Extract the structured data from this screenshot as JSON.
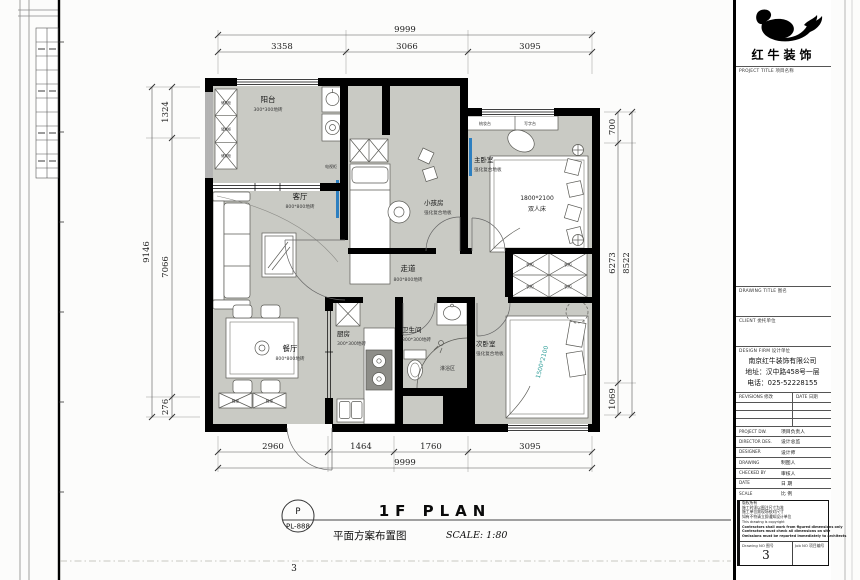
{
  "plan": {
    "rooms": [
      {
        "id": "balcony",
        "name": "阳台",
        "finish": "300*300地砖"
      },
      {
        "id": "living",
        "name": "客厅",
        "finish": "800*800地砖"
      },
      {
        "id": "kids",
        "name": "小孩房",
        "finish": "强化复合地板"
      },
      {
        "id": "master",
        "name": "主卧室",
        "finish": "强化复合地板"
      },
      {
        "id": "corridor",
        "name": "走道",
        "finish": "800*800地砖"
      },
      {
        "id": "dining",
        "name": "餐厅",
        "finish": "800*800地砖"
      },
      {
        "id": "kitchen",
        "name": "厨房",
        "finish": "300*300地砖"
      },
      {
        "id": "bath",
        "name": "卫生间",
        "finish": "300*300地砖"
      },
      {
        "id": "shower",
        "name": "淋浴区"
      },
      {
        "id": "second",
        "name": "次卧室",
        "finish": "强化复合地板"
      }
    ],
    "furniture": {
      "tv_cabinet": "电视柜",
      "dressing_table": "梳妆台",
      "writing_desk": "写字台",
      "master_bed_size": "1800*2100",
      "master_bed_name": "双人床",
      "second_bed_size": "1500*2100",
      "wardrobe": "衣柜",
      "shoe_cabinet": "鞋柜",
      "balcony_cabinet": "储物柜"
    },
    "dimensions": {
      "top": {
        "overall": "9999",
        "segments": [
          "3358",
          "3066",
          "3095"
        ]
      },
      "bottom": {
        "overall": "9999",
        "segments": [
          "2960",
          "1464",
          "1760",
          "3095"
        ]
      },
      "left": {
        "overall": "9146",
        "segments": [
          "1324",
          "7066",
          "276"
        ]
      },
      "right": {
        "overall": "8522",
        "segments": [
          "700",
          "6273",
          "1069"
        ]
      }
    },
    "colors": {
      "wall": "#000000",
      "floor": "#c9cac4",
      "tv_accent": "#2d7fc0",
      "bed_text_teal": "#2f9e99"
    }
  },
  "titlebar": {
    "sheet_letter": "P",
    "sheet_code": "PL-888",
    "title_en": "1F PLAN",
    "title_cn": "平面方案布置图",
    "scale": "SCALE: 1:80",
    "page_no": "3"
  },
  "titleblock": {
    "brand": "红牛装饰",
    "project_title_label": "PROJECT TITLE  项目名称",
    "drawing_title_label": "DRAWING TITLE  图名",
    "client_label": "CLIENT  委托单位",
    "design_firm_label": "DESIGN FIRM  设计单位",
    "firm_name": "南京红牛装饰有限公司",
    "firm_address": "地址：汉中路458号一层",
    "firm_phone": "电话：025-52228155",
    "revisions_label": "REVISIONS  修改",
    "revision_date_label": "DATE  日期",
    "rows": [
      {
        "en": "PROJECT DW.",
        "cn": "项目负责人"
      },
      {
        "en": "DIRECTOR DES.",
        "cn": "设计总监"
      },
      {
        "en": "DESIGNER",
        "cn": "设计师"
      },
      {
        "en": "DRAWING",
        "cn": "制图人"
      },
      {
        "en": "CHECKED BY",
        "cn": "审核人"
      },
      {
        "en": "DATE",
        "cn": "日 期"
      },
      {
        "en": "SCALE",
        "cn": "比 例"
      }
    ],
    "notes_cn": [
      "版权所有",
      "施工时须以图注尺寸为准",
      "施工单位需现场核对尺寸",
      "如有不符请立即通知设计单位"
    ],
    "notes_en": [
      "This drawing is copyright",
      "Contractors shall work from figured dimensions only",
      "Contractors must check all dimensions on site",
      "Omissions must be reported immediately to architects"
    ],
    "drawing_no_label": "Drawing NO  图号",
    "drawing_no": "3",
    "job_no_label": "Job NO  项目编号"
  }
}
